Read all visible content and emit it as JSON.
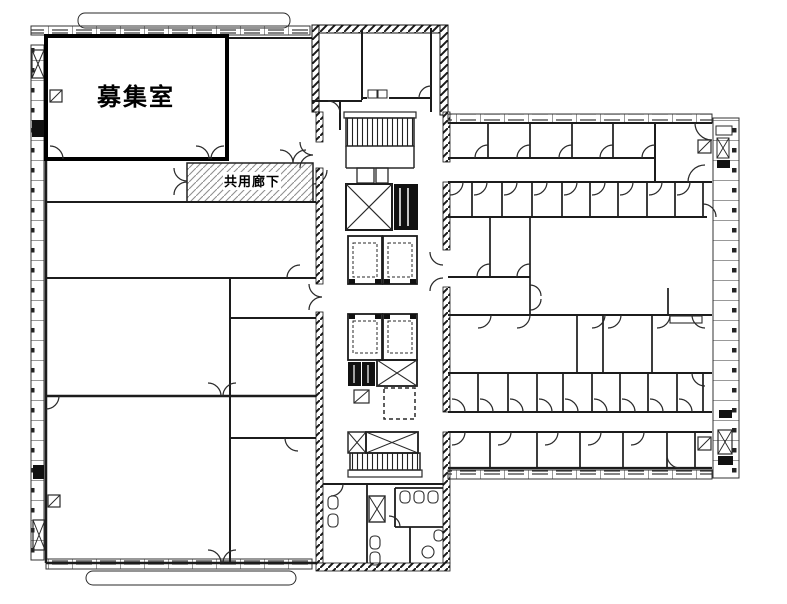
{
  "plan": {
    "vacancy_room_label": "募集室",
    "shared_corridor_label": "共用廊下"
  },
  "colors": {
    "background": "#ffffff",
    "line": "#1c1c1c",
    "dark_fill": "#111111",
    "corridor_hatch": "#8f8f8f"
  },
  "icons": {
    "stair": "stair-treads-icon",
    "elevator_shaft": "x-cross-shaft-icon",
    "elevator_car": "dashed-cab-icon",
    "pipe_shaft": "square-diagonal-icon",
    "toilet_stall": "u-fixture-icon"
  }
}
